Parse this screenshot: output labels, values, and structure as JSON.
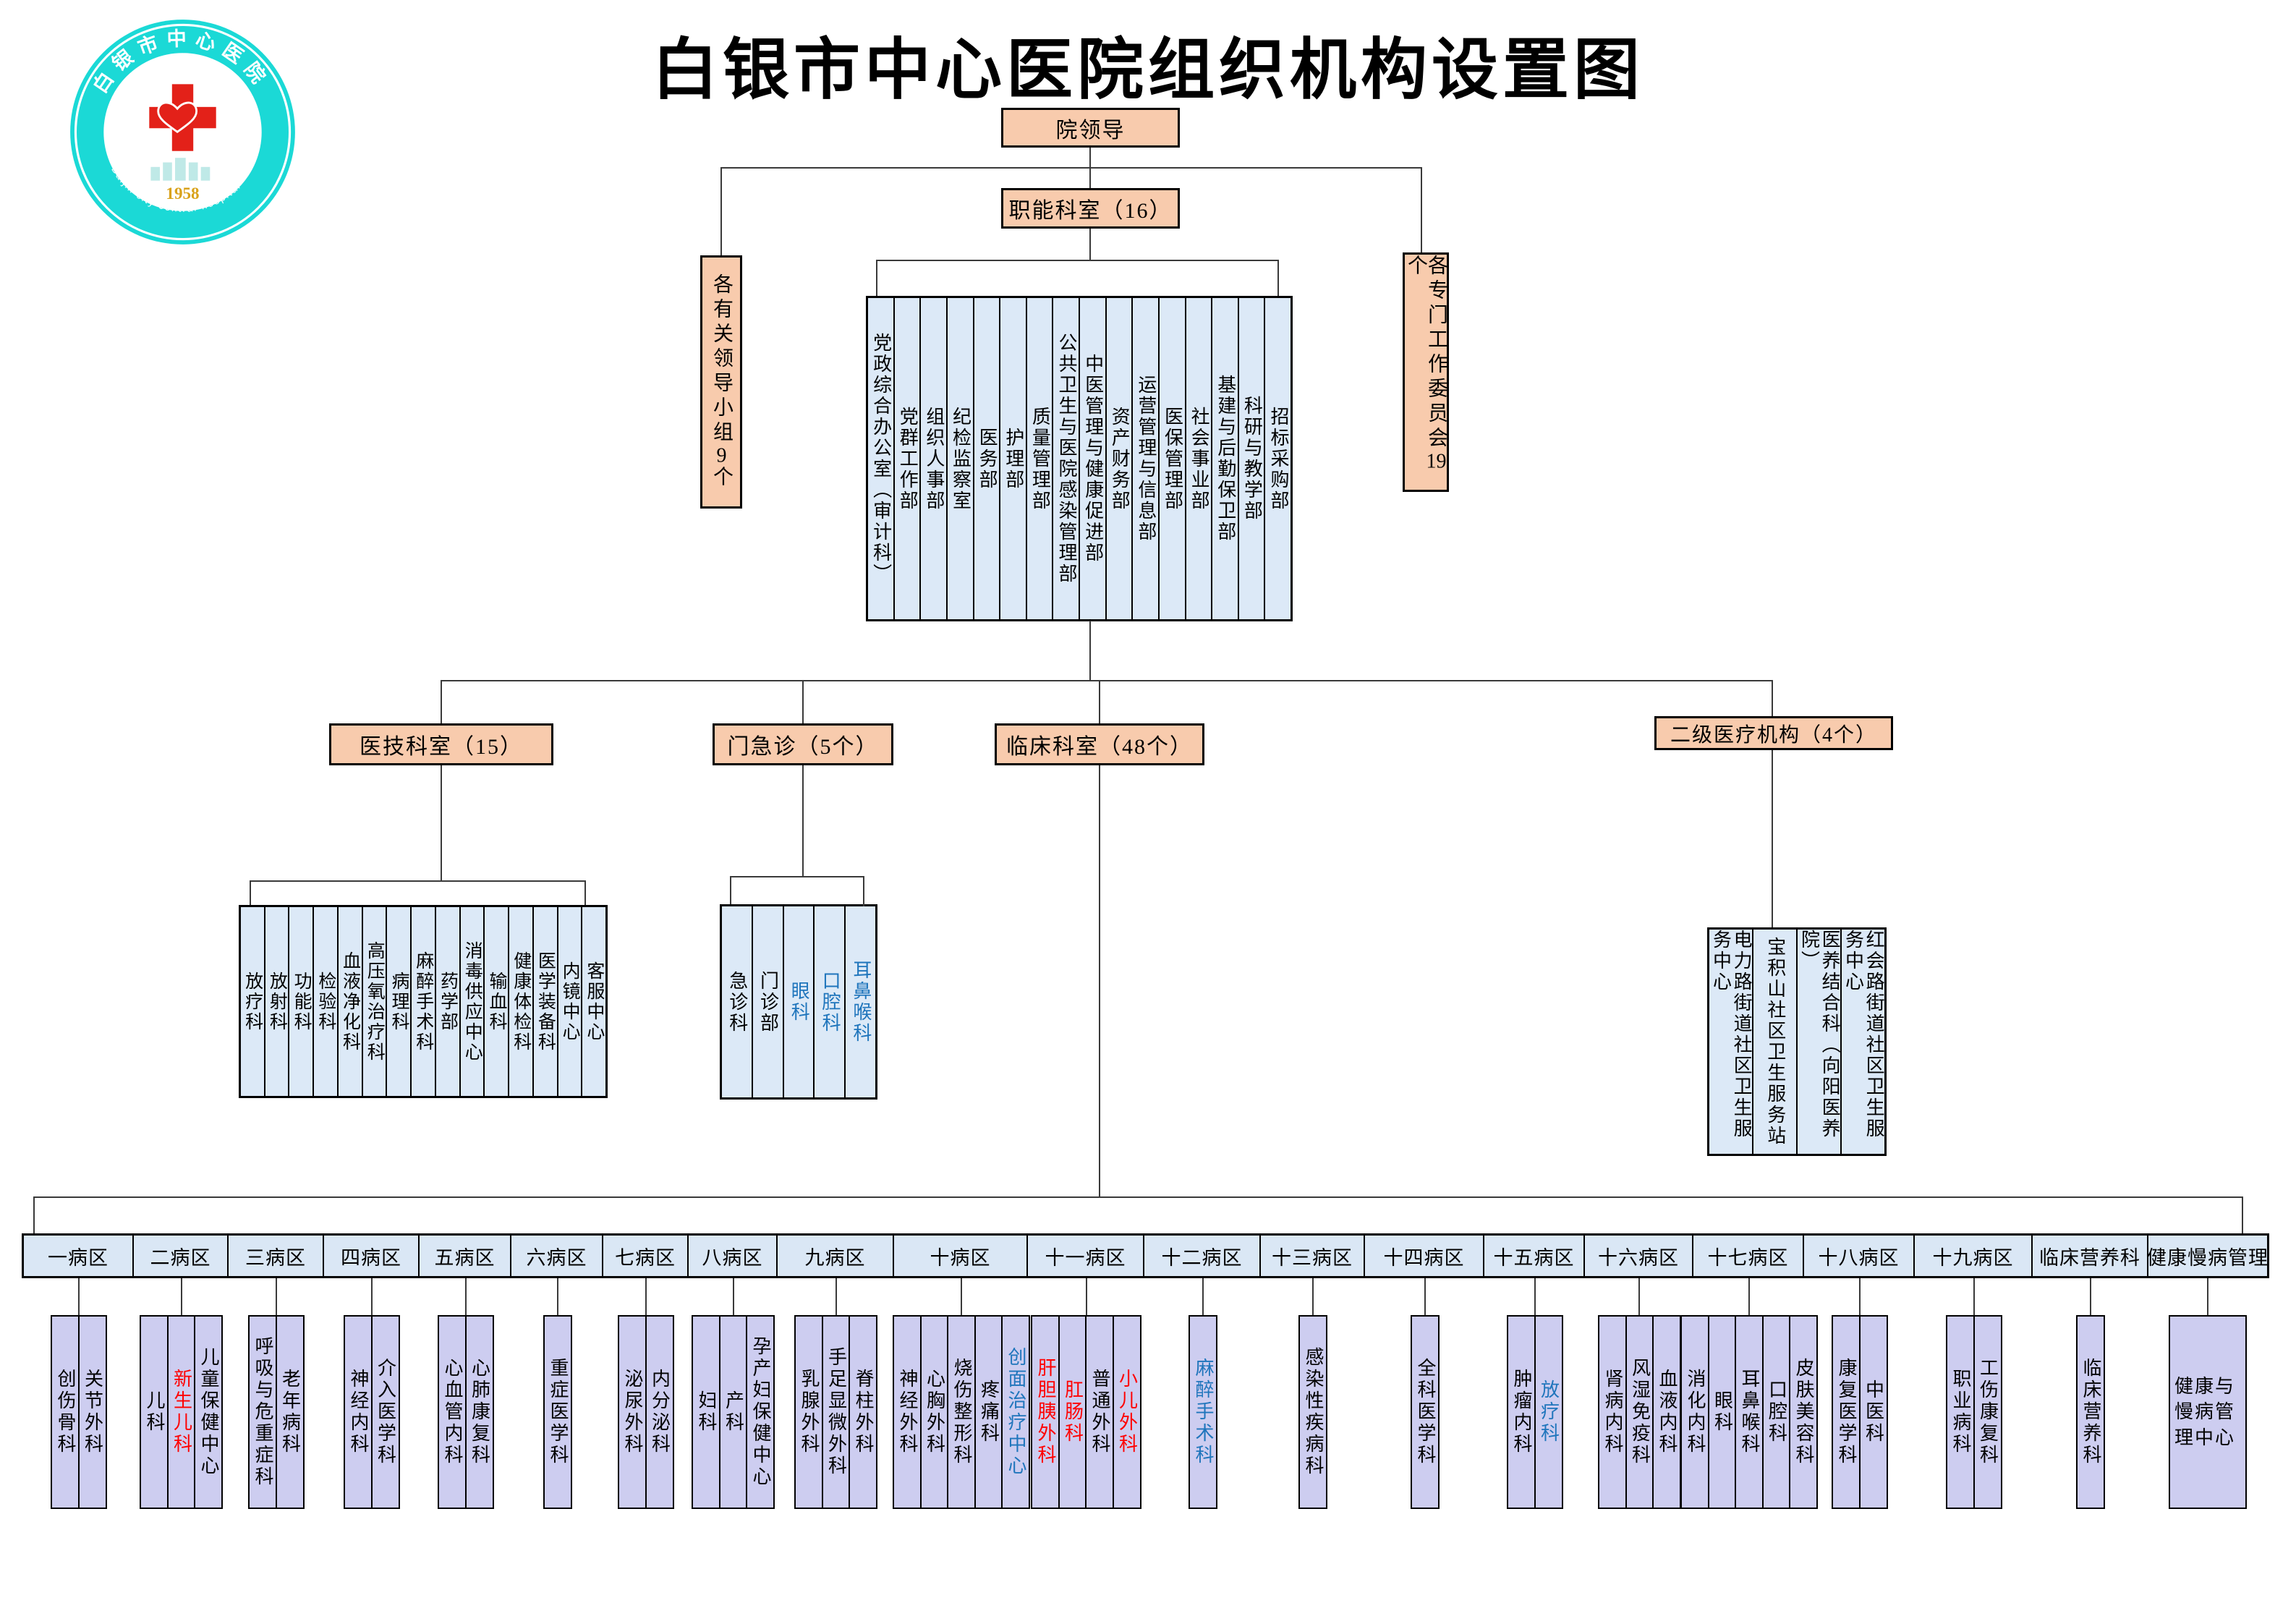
{
  "title": "白银市中心医院组织机构设置图",
  "logo": {
    "ring_text": "白银市中心医院",
    "year": "1958",
    "caption": "Baijin city central hospital"
  },
  "hierarchy": {
    "root_label": "院领导",
    "leading_groups": {
      "text": "各有关领导小组",
      "count": "9",
      "suffix": "个"
    },
    "committees": {
      "text": "各专门工作委员会",
      "count": "19",
      "suffix": "个"
    },
    "functional": {
      "header": "职能科室（16）",
      "departments": [
        "党政综合办公室（审计科）",
        "党群工作部",
        "组织人事部",
        "纪检监察室",
        "医务部",
        "护理部",
        "质量管理部",
        "公共卫生与医院感染管理部",
        "中医管理与健康促进部",
        "资产财务部",
        "运营管理与信息部",
        "医保管理部",
        "社会事业部",
        "基建与后勤保卫部",
        "科研与教学部",
        "招标采购部"
      ]
    },
    "medtech": {
      "header": "医技科室（15）",
      "items": [
        "放疗科",
        "放射科",
        "功能科",
        "检验科",
        "血液净化科",
        "高压氧治疗科",
        "病理科",
        "麻醉手术科",
        "药学部",
        "消毒供应中心",
        "输血科",
        "健康体检科",
        "医学装备科",
        "内镜中心",
        "客服中心"
      ]
    },
    "outpatient": {
      "header": "门急诊（5个）",
      "items": [
        {
          "t": "急诊科"
        },
        {
          "t": "门诊部"
        },
        {
          "t": "眼科",
          "c": "blue"
        },
        {
          "t": "口腔科",
          "c": "blue"
        },
        {
          "t": "耳鼻喉科",
          "c": "blue"
        }
      ]
    },
    "clinical": {
      "header": "临床科室（48个）"
    },
    "secondary": {
      "header": "二级医疗机构（4个）",
      "items": [
        "电力路街道社区卫生服务中心",
        "宝积山社区卫生服务站",
        "医养结合科（向阳医养院）",
        "红会路街道社区卫生服务中心"
      ]
    },
    "wards": [
      {
        "label": "一病区",
        "children": [
          {
            "t": "创伤骨科"
          },
          {
            "t": "关节外科"
          }
        ]
      },
      {
        "label": "二病区",
        "children": [
          {
            "t": "儿科"
          },
          {
            "t": "新生儿科",
            "c": "red"
          },
          {
            "t": "儿童保健中心"
          }
        ]
      },
      {
        "label": "三病区",
        "children": [
          {
            "t": "呼吸与危重症科"
          },
          {
            "t": "老年病科"
          }
        ]
      },
      {
        "label": "四病区",
        "children": [
          {
            "t": "神经内科"
          },
          {
            "t": "介入医学科"
          }
        ]
      },
      {
        "label": "五病区",
        "children": [
          {
            "t": "心血管内科"
          },
          {
            "t": "心肺康复科"
          }
        ]
      },
      {
        "label": "六病区",
        "children": [
          {
            "t": "重症医学科"
          }
        ]
      },
      {
        "label": "七病区",
        "children": [
          {
            "t": "泌尿外科"
          },
          {
            "t": "内分泌科"
          }
        ]
      },
      {
        "label": "八病区",
        "children": [
          {
            "t": "妇科"
          },
          {
            "t": "产科"
          },
          {
            "t": "孕产妇保健中心"
          }
        ]
      },
      {
        "label": "九病区",
        "children": [
          {
            "t": "乳腺外科"
          },
          {
            "t": "手足显微外科"
          },
          {
            "t": "脊柱外科"
          }
        ]
      },
      {
        "label": "十病区",
        "children": [
          {
            "t": "神经外科"
          },
          {
            "t": "心胸外科"
          },
          {
            "t": "烧伤整形科"
          },
          {
            "t": "疼痛科"
          },
          {
            "t": "创面治疗中心",
            "c": "blue"
          }
        ]
      },
      {
        "label": "十一病区",
        "children": [
          {
            "t": "肝胆胰外科",
            "c": "red"
          },
          {
            "t": "肛肠科",
            "c": "red"
          },
          {
            "t": "普通外科"
          },
          {
            "t": "小儿外科",
            "c": "red"
          }
        ]
      },
      {
        "label": "十二病区",
        "children": [
          {
            "t": "麻醉手术科",
            "c": "blue"
          }
        ]
      },
      {
        "label": "十三病区",
        "children": [
          {
            "t": "感染性疾病科"
          }
        ]
      },
      {
        "label": "十四病区",
        "children": [
          {
            "t": "全科医学科"
          }
        ]
      },
      {
        "label": "十五病区",
        "children": [
          {
            "t": "肿瘤内科"
          },
          {
            "t": "放疗科",
            "c": "blue"
          }
        ]
      },
      {
        "label": "十六病区",
        "children": [
          {
            "t": "肾病内科"
          },
          {
            "t": "风湿免疫科"
          },
          {
            "t": "血液内科"
          }
        ]
      },
      {
        "label": "十七病区",
        "children": [
          {
            "t": "消化内科"
          },
          {
            "t": "眼科"
          },
          {
            "t": "耳鼻喉科"
          },
          {
            "t": "口腔科"
          },
          {
            "t": "皮肤美容科"
          }
        ]
      },
      {
        "label": "十八病区",
        "children": [
          {
            "t": "康复医学科"
          },
          {
            "t": "中医科"
          }
        ]
      },
      {
        "label": "十九病区",
        "children": [
          {
            "t": "职业病科"
          },
          {
            "t": "工伤康复科"
          }
        ]
      },
      {
        "label": "临床营养科",
        "children": [
          {
            "t": "临床营养科"
          }
        ]
      },
      {
        "label": "健康慢病管理",
        "children": [
          {
            "t": "健康与慢病管理中心",
            "wide": true
          }
        ]
      }
    ]
  },
  "colors": {
    "accent_peach": "#F8CBAD",
    "light_blue": "#DCE9F7",
    "lavender": "#CDCDF0",
    "blue_text": "#1F75BC",
    "red_text": "#FF0000"
  }
}
